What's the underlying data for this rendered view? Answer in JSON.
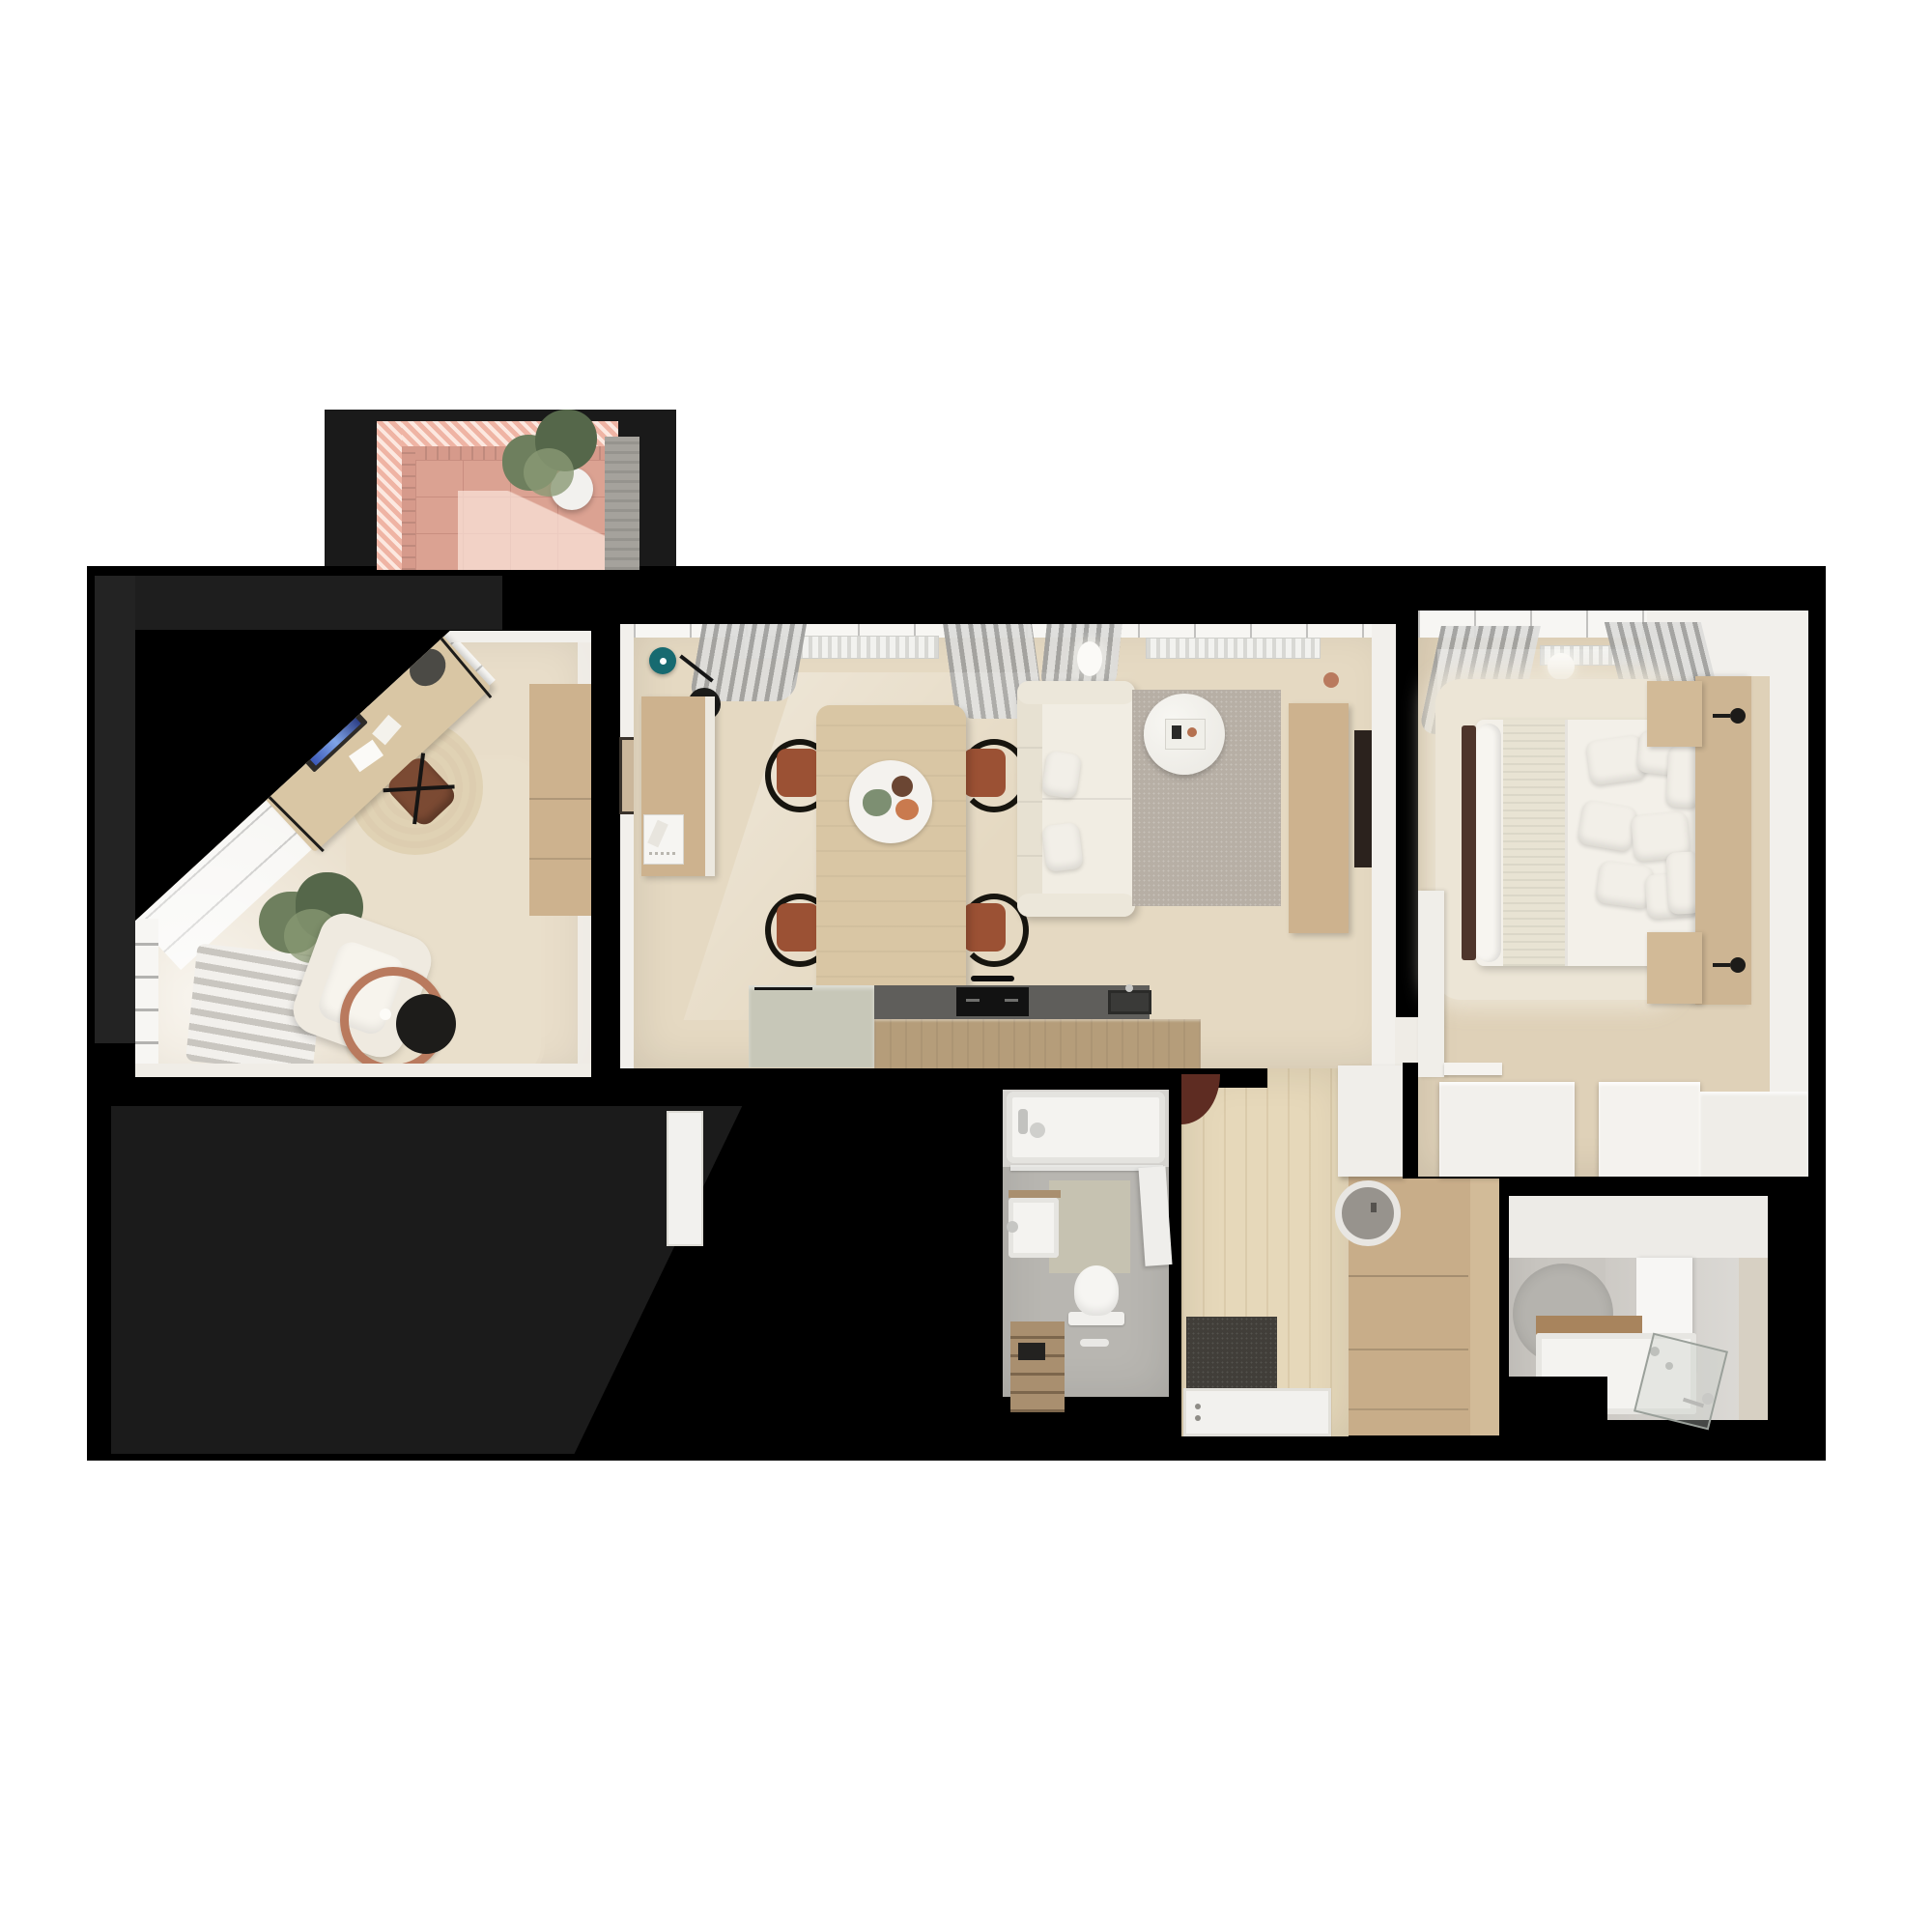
{
  "scene": {
    "kind": "3d-floorplan-top-down-render",
    "background": "#ffffff",
    "mask_color": "#000000"
  },
  "palette": {
    "bg": "#ffffff",
    "maskBlack": "#000000",
    "maskShadow1": "#232323",
    "maskShadow2": "#1e1e1e",
    "maskShadow3": "#1b1b1b",
    "balconyBackdrop": "#1a1a1a",
    "pinkStripeA": "#efb4a4",
    "pinkStripeB": "#fce8e0",
    "pinkBrick": "#d69a8b",
    "pinkTile": "#dba292",
    "pinkGrout": "#c98e80",
    "concrete": "#a5a29c",
    "plantDark": "#55674a",
    "plantMid": "#6e7f5e",
    "plantLight": "#8a9a74",
    "potWhite": "#f2f1ee",
    "floorOffice": "#e8ddc9",
    "floorLiving": "#e5d9c2",
    "floorBedroom": "#dfd1b8",
    "floorHall": "#e6d8ba",
    "wallWhite": "#f2f0ec",
    "windowWhite": "#f7f6f3",
    "woodCabinet": "#cdb28e",
    "woodCounterFront": "#b59d7a",
    "woodDesk": "#d9c6a4",
    "woodShelfDark": "#a98f6f",
    "woodWardrobe": "#c8ad89",
    "woodHeadboard": "#cdb593",
    "counterDark": "#5f5e5b",
    "hobBlack": "#121212",
    "sinkDark": "#3a3a38",
    "sage": "#c7c7b8",
    "sofaWhite": "#f1ede3",
    "cushion": "#e4decf",
    "rugGray": "#b7afa5",
    "rugJute": "#e0d2b4",
    "rugBig": "#e9dfcb",
    "rugFluffy": "#ece5d6",
    "rugBath": "#b5b3ae",
    "terracotta": "#9b5134",
    "chairBlack": "#17150f",
    "teal": "#176a70",
    "copper": "#b97a5e",
    "bathFloor": "#b8b6b1",
    "bathFloor2": "#cdcac5",
    "fixtureWhite": "#f4f3f0",
    "matBeige": "#c6c2b1",
    "doormat": "#413e39",
    "doorWhite": "#f2f1ee",
    "tvDark": "#2b221d",
    "footboard": "#4e352b",
    "redArc": "#5e2c22",
    "knit": "#e8e3d3"
  },
  "rooms": [
    {
      "id": "balcony",
      "features": [
        "striped-pink-pergola",
        "pink-tile-floor",
        "potted-plant",
        "concrete-wall"
      ]
    },
    {
      "id": "home-office",
      "features": [
        "diagonal-window-wall",
        "desk",
        "monitor",
        "desk-chair",
        "round-jute-rug",
        "large-area-rug",
        "floor-plant",
        "armchair",
        "copper-arc-lamp",
        "black-side-table",
        "wood-wardrobe",
        "striped-gray-daybed"
      ]
    },
    {
      "id": "living-dining-kitchen",
      "features": [
        "teal-pendant-lamp",
        "white-pendant-lamp",
        "tall-wood-cabinet",
        "framed-picture",
        "dining-table",
        "four-terracotta-chairs",
        "centerpiece",
        "sofa",
        "gray-rug",
        "round-coffee-table",
        "tv-cabinet",
        "wall-tv",
        "copper-vase",
        "kitchen-island",
        "dark-countertop",
        "cooktop",
        "kitchen-sink",
        "curtains",
        "radiators"
      ]
    },
    {
      "id": "bedroom",
      "features": [
        "double-bed",
        "knit-throw",
        "pillows",
        "wood-headboard",
        "two-nightstands",
        "two-wall-sconces",
        "fluffy-rug",
        "footboard-bench",
        "white-wardrobe",
        "wall-shelf",
        "dresser-row",
        "curtains",
        "radiator",
        "ceiling-lamp"
      ]
    },
    {
      "id": "bathroom-wc",
      "features": [
        "bathtub",
        "tub-faucet",
        "glass-screen",
        "bath-mat",
        "washbasin",
        "toilet",
        "wood-shelf-unit",
        "floor-drain",
        "wall-ledge"
      ]
    },
    {
      "id": "hallway",
      "features": [
        "open-red-door-leaf",
        "doormat",
        "entry-door-panel",
        "wood-wardrobe",
        "washing-machine-porthole",
        "white-hall-cabinet"
      ]
    },
    {
      "id": "bathroom-shower",
      "features": [
        "round-rug",
        "vanity-basin",
        "wood-shelf",
        "tall-shower-panel",
        "glass-shower-screen",
        "hand-shower"
      ]
    }
  ]
}
